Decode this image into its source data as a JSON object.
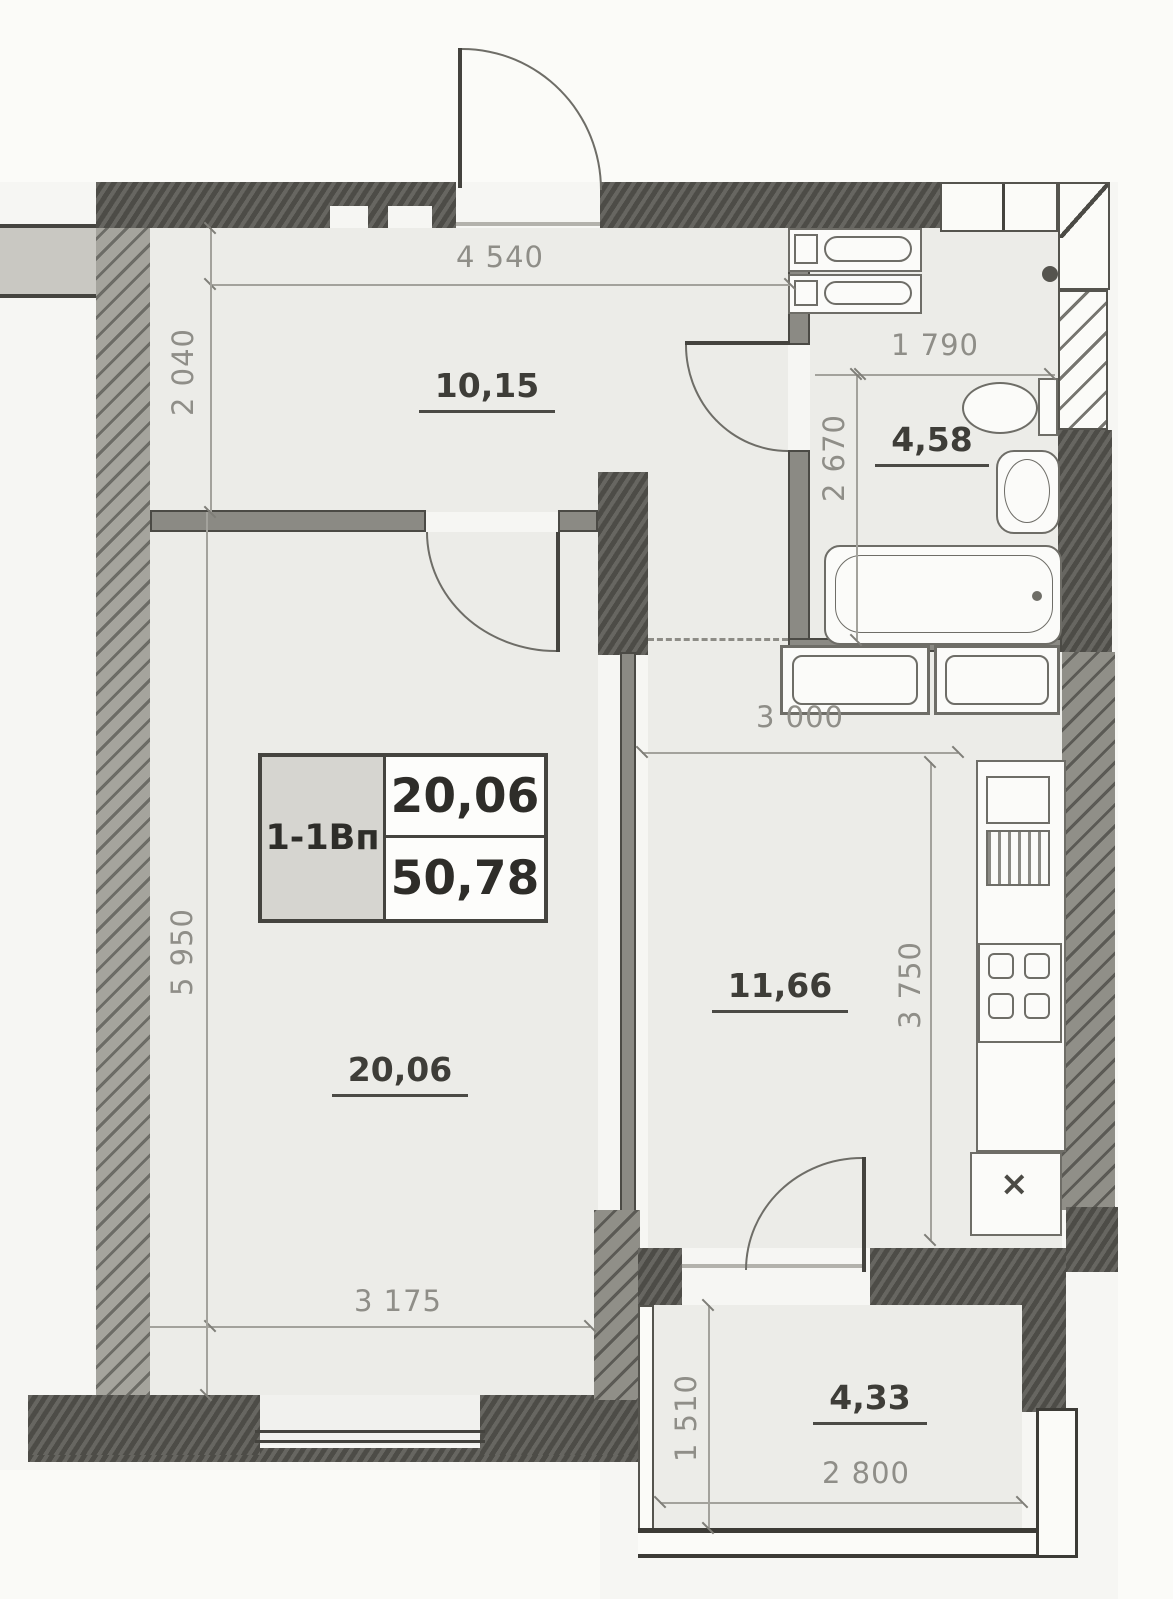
{
  "plan": {
    "title_box": {
      "unit": "1-1Вп",
      "room_area": "20,06",
      "total_area": "50,78"
    },
    "rooms": [
      {
        "id": "hall",
        "area": "10,15"
      },
      {
        "id": "living",
        "area": "20,06"
      },
      {
        "id": "bathroom",
        "area": "4,58"
      },
      {
        "id": "kitchen",
        "area": "11,66"
      },
      {
        "id": "balcony",
        "area": "4,33"
      }
    ],
    "dimensions": {
      "hall_width": "4 540",
      "hall_depth": "2 040",
      "bathroom_width": "1 790",
      "bathroom_depth": "2 670",
      "kitchen_width": "3 000",
      "kitchen_depth": "3 750",
      "living_depth": "5 950",
      "living_width": "3 175",
      "balcony_depth": "1 510",
      "balcony_width": "2 800"
    },
    "symbols": {
      "vent": "×"
    }
  },
  "colors": {
    "wall_dark": "#56554f",
    "wall_hatch": "#a5a49d",
    "paper": "#f6f6f3",
    "room_fill": "#ecece8",
    "dim_text": "#8f8e88",
    "label_text": "#3e3d38"
  }
}
